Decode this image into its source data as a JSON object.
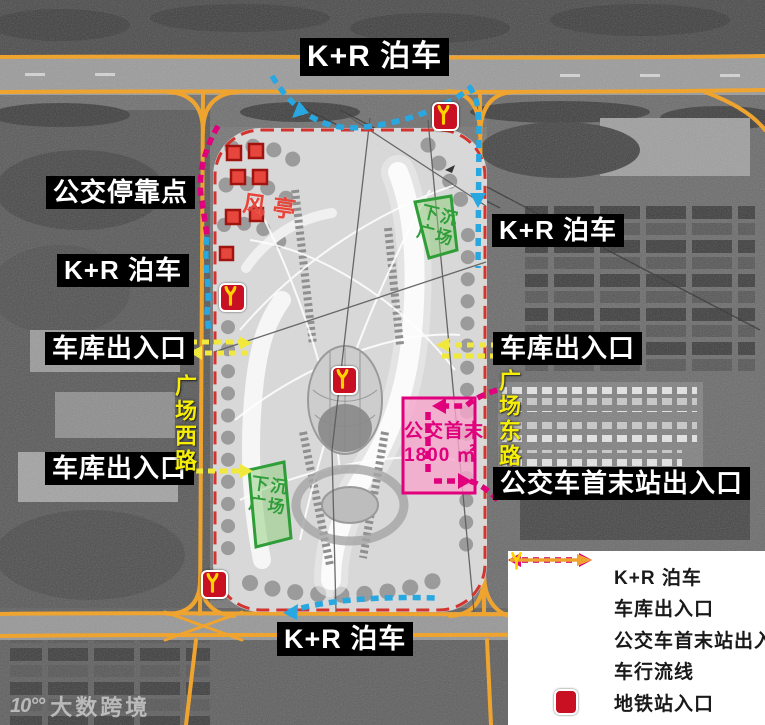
{
  "map": {
    "annotations": {
      "kr_top": "K+R 泊车",
      "bus_stop": "公交停靠点",
      "kr_left": "K+R 泊车",
      "garage_left_top": "车库出入口",
      "garage_left_bottom": "车库出入口",
      "kr_right": "K+R 泊车",
      "garage_right": "车库出入口",
      "bus_terminal_exit": "公交车首末站出入口",
      "kr_bottom": "K+R 泊车",
      "wind_pavilion": "风亭"
    },
    "road_names": {
      "west": "广场西路",
      "east": "广场东路"
    },
    "sunken_plaza": {
      "line1": "下沉",
      "line2": "广场"
    },
    "bus_terminus": {
      "name": "公交首末",
      "area": "1800 ㎡"
    }
  },
  "legend": {
    "items": [
      {
        "name": "kr-parking",
        "label": "K+R 泊车",
        "color": "#29a7e0",
        "style": "dashed-double-arrow"
      },
      {
        "name": "garage-access",
        "label": "车库出入口",
        "color": "#f2e83a",
        "style": "dashed-double-arrow"
      },
      {
        "name": "bus-terminal-access",
        "label": "公交车首末站出入口",
        "color": "#e0007c",
        "style": "dashed-double-arrow"
      },
      {
        "name": "vehicle-flow",
        "label": "车行流线",
        "color": "#efa42f",
        "style": "solid-arrow"
      },
      {
        "name": "metro-entrance",
        "label": "地铁站入口",
        "icon": "metro-icon",
        "color": "#c81022"
      }
    ]
  },
  "watermark": {
    "icon": "10°°",
    "text": "大数跨境"
  },
  "colors": {
    "kr_route": "#29a7e0",
    "garage_route": "#f2e83a",
    "bus_route": "#e0007c",
    "road": "#efa42f",
    "site_border": "#d23430",
    "metro_red": "#c81022",
    "metro_yellow": "#ffd200",
    "plaza_green": "#2f9e38",
    "terminus_pink": "#e0007c"
  }
}
